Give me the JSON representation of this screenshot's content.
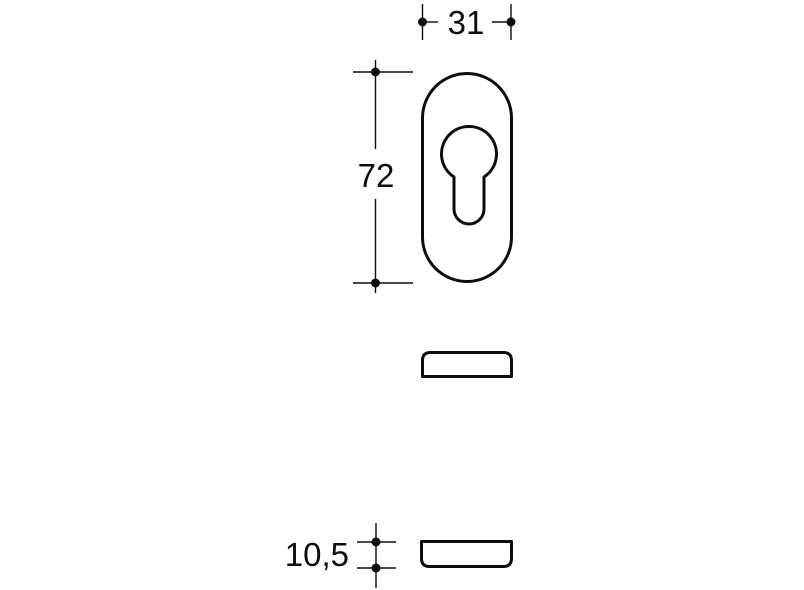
{
  "drawing": {
    "background_color": "#ffffff",
    "line_color": "#0d0d0d",
    "views": {
      "front": "oval-escutcheon-with-euro-profile-cutout",
      "side_upper": "profile-rounded-top-corners",
      "side_lower": "profile-rounded-bottom-corners"
    },
    "dimensions": {
      "width": {
        "label": "31"
      },
      "height": {
        "label": "72"
      },
      "thickness": {
        "label": "10,5"
      }
    }
  }
}
